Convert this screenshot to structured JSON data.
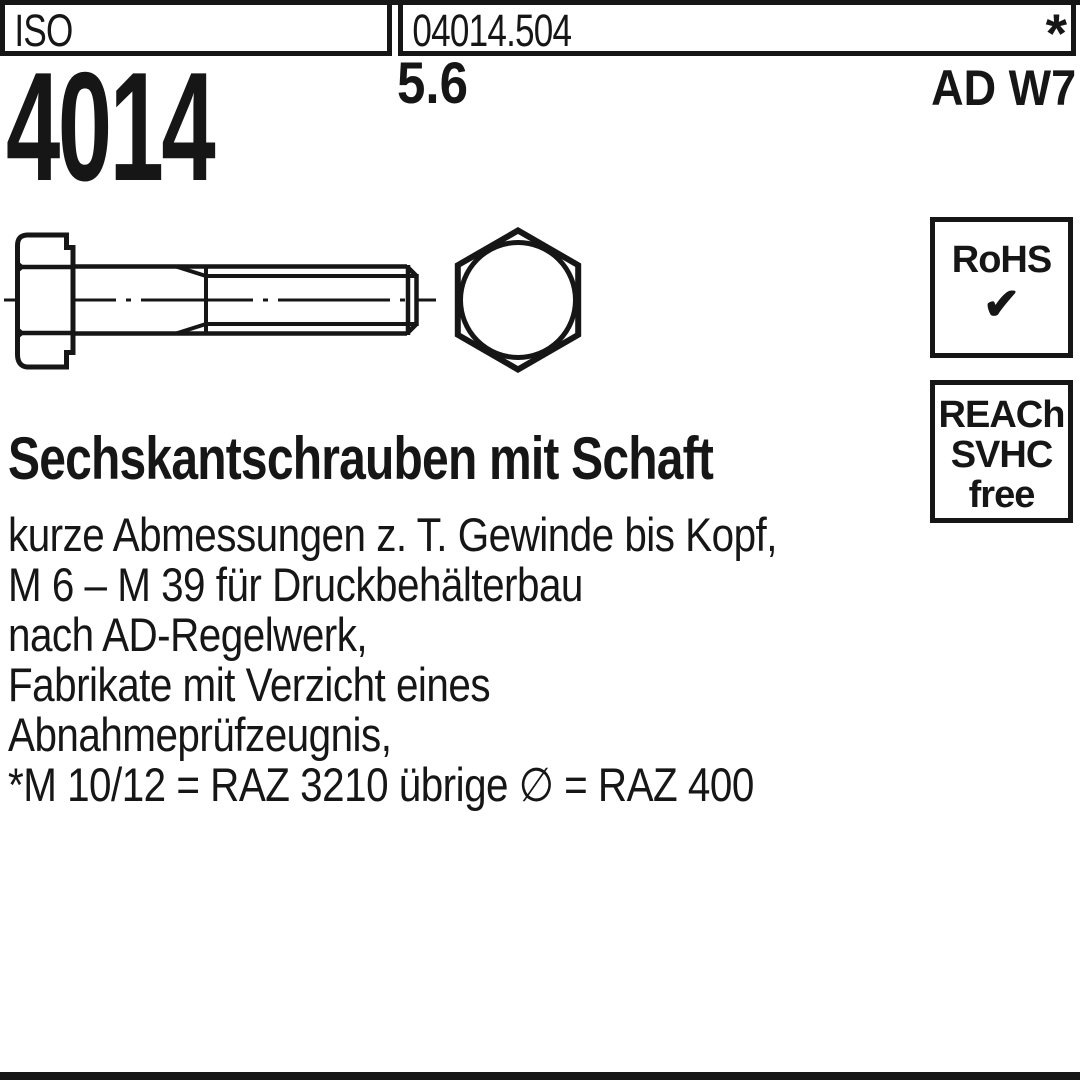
{
  "colors": {
    "ink": "#161616",
    "background": "#ffffff"
  },
  "header": {
    "standard_org": "ISO",
    "article_number": "04014.504",
    "footnote_marker": "*",
    "standard_number": "4014",
    "strength_class": "5.6",
    "approval": "AD W7"
  },
  "badges": {
    "rohs_label": "RoHS",
    "rohs_check": "✔",
    "reach_line1": "REACh",
    "reach_line2": "SVHC",
    "reach_line3": "free"
  },
  "product": {
    "title": "Sechskantschrauben mit Schaft",
    "description": [
      "kurze Abmessungen z. T. Gewinde bis Kopf,",
      "M 6 – M 39 für Druckbehälterbau",
      "nach AD-Regelwerk,",
      "Fabrikate mit Verzicht eines",
      "Abnahmeprüfzeugnis,",
      "*M 10/12 = RAZ 3210 übrige ∅ = RAZ 400"
    ]
  }
}
